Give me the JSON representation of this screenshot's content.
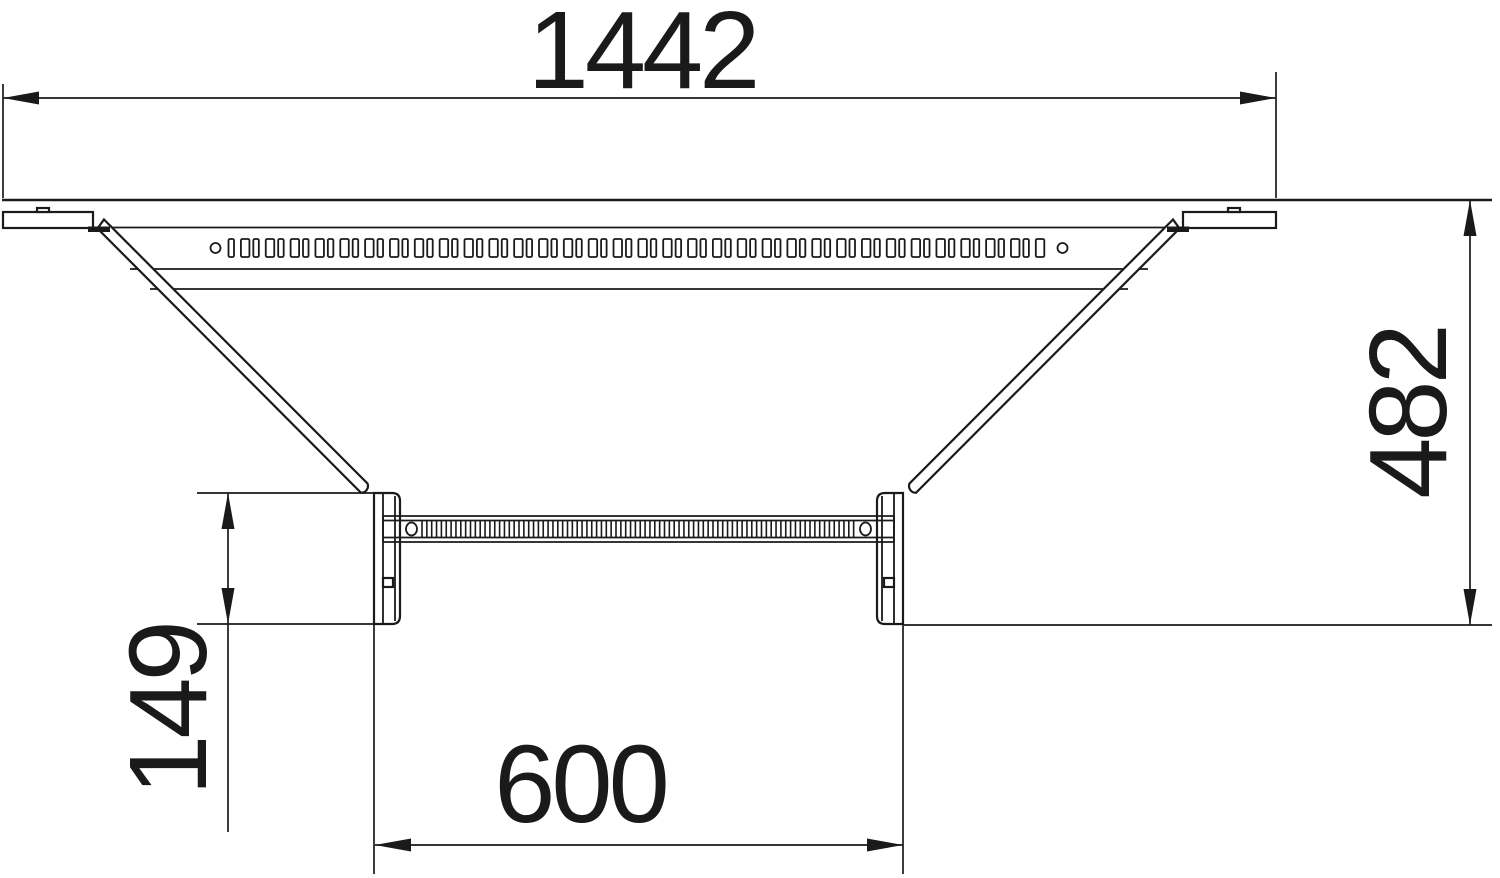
{
  "drawing": {
    "background": "#ffffff",
    "line_color": "#1a1a1a"
  },
  "dimensions": {
    "top": {
      "label": "1442",
      "orientation": "horizontal"
    },
    "right": {
      "label": "482",
      "orientation": "vertical"
    },
    "left": {
      "label": "149",
      "orientation": "vertical"
    },
    "bottom": {
      "label": "600",
      "orientation": "horizontal"
    }
  },
  "perforations": {
    "top_slot_count": 66,
    "top_end_hole_count": 2,
    "rung_rib_count": 90,
    "rung_oval_hole_count": 2
  }
}
